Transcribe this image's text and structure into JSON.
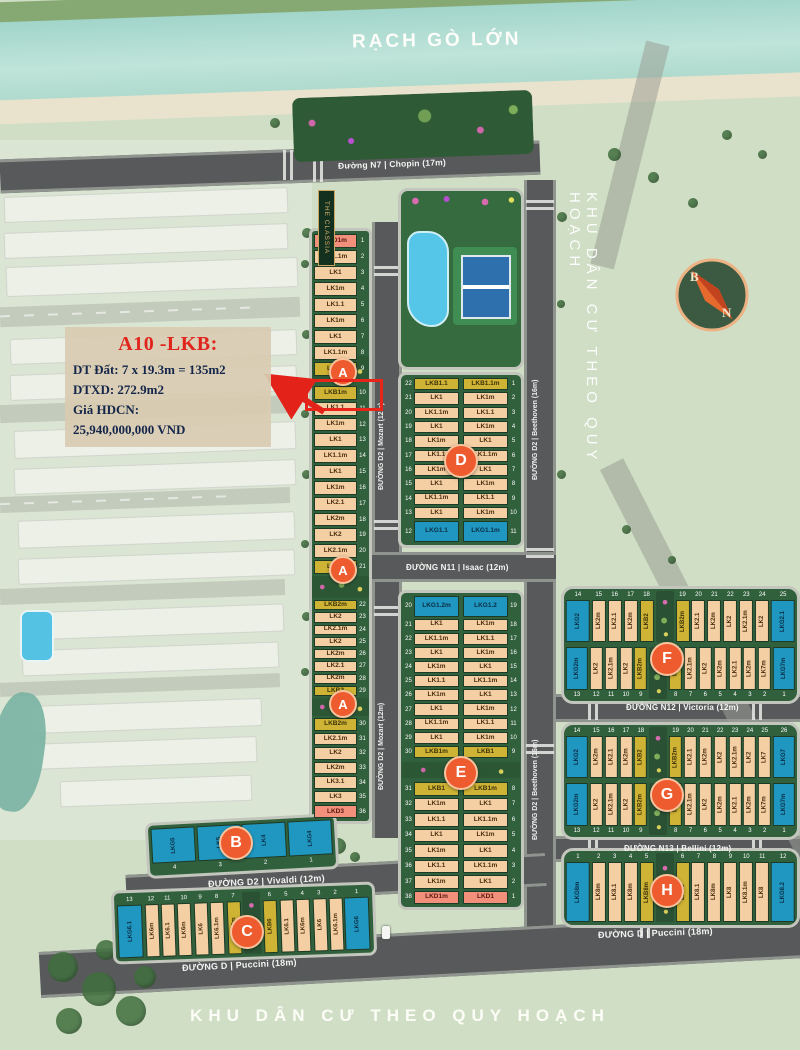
{
  "labels": {
    "river": "RẠCH GÒ LỚN",
    "zone_right": "KHU DÂN CƯ THEO QUY HOẠCH",
    "zone_bottom": "KHU DÂN CƯ THEO QUY HOẠCH",
    "project_sign": "THE CLASSIA"
  },
  "compass": {
    "north": "B",
    "south": "N"
  },
  "annotation": {
    "title": "A10 -LKB:",
    "line1": "DT Đất: 7 x 19.3m = 135m2",
    "line2": "DTXD: 272.9m2",
    "line3": "Giá HDCN:",
    "line4": "25,940,000,000 VND"
  },
  "roads": {
    "n7": "Đường N7 | Chopin (17m)",
    "mozart": "ĐƯỜNG D2 | Mozart (12m)",
    "beethoven": "ĐƯỜNG D2 | Beethoven (16m)",
    "isaac": "ĐƯỜNG N11 | Isaac (12m)",
    "victoria": "ĐƯỜNG N12 | Victoria (12m)",
    "bellini": "ĐƯỜNG N13 | Bellini (12m)",
    "vivaldi": "ĐƯỜNG D2 | Vivaldi (12m)",
    "puccini": "ĐƯỜNG D | Puccini (18m)"
  },
  "badges": {
    "a": "A",
    "b": "B",
    "c": "C",
    "d": "D",
    "e": "E",
    "f": "F",
    "g": "G",
    "h": "H"
  },
  "colors": {
    "lot_tan": "#f4cfa3",
    "lot_yellow": "#cfb335",
    "lot_salmon": "#f2907b",
    "lot_blue": "#2097c0",
    "block_green": "#31603c",
    "badge_orange": "#ed5b2f",
    "road_gray": "#57595b",
    "highlight_red": "#e8251a",
    "river_teal": "#a2d5ca"
  },
  "blocks": {
    "a1": [
      {
        "n": 1,
        "t": "LKD1m",
        "c": "s"
      },
      {
        "n": 2,
        "t": "LK1.1m",
        "c": "t"
      },
      {
        "n": 3,
        "t": "LK1",
        "c": "t"
      },
      {
        "n": 4,
        "t": "LK1m",
        "c": "t"
      },
      {
        "n": 5,
        "t": "LK1.1",
        "c": "t"
      },
      {
        "n": 6,
        "t": "LK1m",
        "c": "t"
      },
      {
        "n": 7,
        "t": "LK1",
        "c": "t"
      },
      {
        "n": 8,
        "t": "LK1.1m",
        "c": "t"
      },
      {
        "n": 9,
        "t": "LKB1",
        "c": "y"
      }
    ],
    "a2": [
      {
        "n": 10,
        "t": "LKB1m",
        "c": "y"
      },
      {
        "n": 11,
        "t": "LK1.1",
        "c": "t"
      },
      {
        "n": 12,
        "t": "LK1m",
        "c": "t"
      },
      {
        "n": 13,
        "t": "LK1",
        "c": "t"
      },
      {
        "n": 14,
        "t": "LK1.1m",
        "c": "t"
      },
      {
        "n": 15,
        "t": "LK1",
        "c": "t"
      },
      {
        "n": 16,
        "t": "LK1m",
        "c": "t"
      },
      {
        "n": 17,
        "t": "LK2.1",
        "c": "t"
      },
      {
        "n": 18,
        "t": "LK2m",
        "c": "t"
      },
      {
        "n": 19,
        "t": "LK2",
        "c": "t"
      },
      {
        "n": 20,
        "t": "LK2.1m",
        "c": "t"
      },
      {
        "n": 21,
        "t": "LKB2",
        "c": "y"
      }
    ],
    "a3": [
      {
        "n": 22,
        "t": "LKB2m",
        "c": "y"
      },
      {
        "n": 23,
        "t": "LK2",
        "c": "t"
      },
      {
        "n": 24,
        "t": "LK2.1m",
        "c": "t"
      },
      {
        "n": 25,
        "t": "LK2",
        "c": "t"
      },
      {
        "n": 26,
        "t": "LK2m",
        "c": "t"
      },
      {
        "n": 27,
        "t": "LK2.1",
        "c": "t"
      },
      {
        "n": 28,
        "t": "LK2m",
        "c": "t"
      },
      {
        "n": 29,
        "t": "LKB2",
        "c": "y"
      }
    ],
    "a4": [
      {
        "n": 30,
        "t": "LKB2m",
        "c": "y"
      },
      {
        "n": 31,
        "t": "LK2.1m",
        "c": "t"
      },
      {
        "n": 32,
        "t": "LK2",
        "c": "t"
      },
      {
        "n": 33,
        "t": "LK2m",
        "c": "t"
      },
      {
        "n": 34,
        "t": "LK3.1",
        "c": "t"
      },
      {
        "n": 35,
        "t": "LK3",
        "c": "t"
      },
      {
        "n": 36,
        "t": "LKD3",
        "c": "s"
      }
    ],
    "d_left": [
      {
        "n": 22,
        "t": "LKB1.1",
        "c": "y"
      },
      {
        "n": 21,
        "t": "LK1",
        "c": "t"
      },
      {
        "n": 20,
        "t": "LK1.1m",
        "c": "t"
      },
      {
        "n": 19,
        "t": "LK1",
        "c": "t"
      },
      {
        "n": 18,
        "t": "LK1m",
        "c": "t"
      },
      {
        "n": 17,
        "t": "LK1.1",
        "c": "t"
      },
      {
        "n": 16,
        "t": "LK1m",
        "c": "t"
      },
      {
        "n": 15,
        "t": "LK1",
        "c": "t"
      },
      {
        "n": 14,
        "t": "LK1.1m",
        "c": "t"
      },
      {
        "n": 13,
        "t": "LK1",
        "c": "t"
      },
      {
        "n": 12,
        "t": "LKG1.1",
        "c": "b"
      }
    ],
    "d_right": [
      {
        "n": 1,
        "t": "LKB1.1m",
        "c": "y"
      },
      {
        "n": 2,
        "t": "LK1m",
        "c": "t"
      },
      {
        "n": 3,
        "t": "LK1.1",
        "c": "t"
      },
      {
        "n": 4,
        "t": "LK1m",
        "c": "t"
      },
      {
        "n": 5,
        "t": "LK1",
        "c": "t"
      },
      {
        "n": 6,
        "t": "LK1.1m",
        "c": "t"
      },
      {
        "n": 7,
        "t": "LK1",
        "c": "t"
      },
      {
        "n": 8,
        "t": "LK1m",
        "c": "t"
      },
      {
        "n": 9,
        "t": "LK1.1",
        "c": "t"
      },
      {
        "n": 10,
        "t": "LK1m",
        "c": "t"
      },
      {
        "n": 11,
        "t": "LKG1.1m",
        "c": "b"
      }
    ],
    "e_top_left": [
      {
        "n": 20,
        "t": "LKG1.2m",
        "c": "b"
      },
      {
        "n": 21,
        "t": "LK1",
        "c": "t"
      },
      {
        "n": 22,
        "t": "LK1.1m",
        "c": "t"
      },
      {
        "n": 23,
        "t": "LK1",
        "c": "t"
      },
      {
        "n": 24,
        "t": "LK1m",
        "c": "t"
      },
      {
        "n": 25,
        "t": "LK1.1",
        "c": "t"
      },
      {
        "n": 26,
        "t": "LK1m",
        "c": "t"
      },
      {
        "n": 27,
        "t": "LK1",
        "c": "t"
      },
      {
        "n": 28,
        "t": "LK1.1m",
        "c": "t"
      },
      {
        "n": 29,
        "t": "LK1",
        "c": "t"
      },
      {
        "n": 30,
        "t": "LKB1m",
        "c": "y"
      }
    ],
    "e_top_right": [
      {
        "n": 19,
        "t": "LKG1.2",
        "c": "b"
      },
      {
        "n": 18,
        "t": "LK1m",
        "c": "t"
      },
      {
        "n": 17,
        "t": "LK1.1",
        "c": "t"
      },
      {
        "n": 16,
        "t": "LK1m",
        "c": "t"
      },
      {
        "n": 15,
        "t": "LK1",
        "c": "t"
      },
      {
        "n": 14,
        "t": "LK1.1m",
        "c": "t"
      },
      {
        "n": 13,
        "t": "LK1",
        "c": "t"
      },
      {
        "n": 12,
        "t": "LK1m",
        "c": "t"
      },
      {
        "n": 11,
        "t": "LK1.1",
        "c": "t"
      },
      {
        "n": 10,
        "t": "LK1m",
        "c": "t"
      },
      {
        "n": 9,
        "t": "LKB1",
        "c": "y"
      }
    ],
    "e_bot_left": [
      {
        "n": 31,
        "t": "LKB1",
        "c": "y"
      },
      {
        "n": 32,
        "t": "LK1m",
        "c": "t"
      },
      {
        "n": 33,
        "t": "LK1.1",
        "c": "t"
      },
      {
        "n": 34,
        "t": "LK1",
        "c": "t"
      },
      {
        "n": 35,
        "t": "LK1m",
        "c": "t"
      },
      {
        "n": 36,
        "t": "LK1.1",
        "c": "t"
      },
      {
        "n": 37,
        "t": "LK1m",
        "c": "t"
      },
      {
        "n": 38,
        "t": "LKD1m",
        "c": "s"
      }
    ],
    "e_bot_right": [
      {
        "n": 8,
        "t": "LKB1m",
        "c": "y"
      },
      {
        "n": 7,
        "t": "LK1",
        "c": "t"
      },
      {
        "n": 6,
        "t": "LK1.1m",
        "c": "t"
      },
      {
        "n": 5,
        "t": "LK1m",
        "c": "t"
      },
      {
        "n": 4,
        "t": "LK1",
        "c": "t"
      },
      {
        "n": 3,
        "t": "LK1.1m",
        "c": "t"
      },
      {
        "n": 2,
        "t": "LK1",
        "c": "t"
      },
      {
        "n": 1,
        "t": "LKD1",
        "c": "s"
      }
    ],
    "f_top": [
      {
        "n": 14,
        "t": "LKG2",
        "c": "b"
      },
      {
        "n": 15,
        "t": "LK2m",
        "c": "t"
      },
      {
        "n": 16,
        "t": "LK2.1",
        "c": "t"
      },
      {
        "n": 17,
        "t": "LK2m",
        "c": "t"
      },
      {
        "n": 18,
        "t": "LKB2",
        "c": "y"
      },
      {
        "gap": true
      },
      {
        "n": 19,
        "t": "LKB2m",
        "c": "y"
      },
      {
        "n": 20,
        "t": "LK2.1",
        "c": "t"
      },
      {
        "n": 21,
        "t": "LK2m",
        "c": "t"
      },
      {
        "n": 22,
        "t": "LK2",
        "c": "t"
      },
      {
        "n": 23,
        "t": "LK2.1m",
        "c": "t"
      },
      {
        "n": 24,
        "t": "LK2",
        "c": "t"
      },
      {
        "n": 25,
        "t": "LKG2.1",
        "c": "b"
      }
    ],
    "f_bot": [
      {
        "n": 13,
        "t": "LKG2m",
        "c": "b"
      },
      {
        "n": 12,
        "t": "LK2",
        "c": "t"
      },
      {
        "n": 11,
        "t": "LK2.1m",
        "c": "t"
      },
      {
        "n": 10,
        "t": "LK2",
        "c": "t"
      },
      {
        "n": 9,
        "t": "LKB2m",
        "c": "y"
      },
      {
        "gap": true
      },
      {
        "n": 8,
        "t": "LKB2",
        "c": "y"
      },
      {
        "n": 7,
        "t": "LK2.1m",
        "c": "t"
      },
      {
        "n": 6,
        "t": "LK2",
        "c": "t"
      },
      {
        "n": 5,
        "t": "LK2m",
        "c": "t"
      },
      {
        "n": 4,
        "t": "LK2.1",
        "c": "t"
      },
      {
        "n": 3,
        "t": "LK2m",
        "c": "t"
      },
      {
        "n": 2,
        "t": "LK7m",
        "c": "t"
      },
      {
        "n": 1,
        "t": "LKG7m",
        "c": "b"
      }
    ],
    "g_top": [
      {
        "n": 14,
        "t": "LKG2",
        "c": "b"
      },
      {
        "n": 15,
        "t": "LK2m",
        "c": "t"
      },
      {
        "n": 16,
        "t": "LK2.1",
        "c": "t"
      },
      {
        "n": 17,
        "t": "LK2m",
        "c": "t"
      },
      {
        "n": 18,
        "t": "LKB2",
        "c": "y"
      },
      {
        "gap": true
      },
      {
        "n": 19,
        "t": "LKB2m",
        "c": "y"
      },
      {
        "n": 20,
        "t": "LK2.1",
        "c": "t"
      },
      {
        "n": 21,
        "t": "LK2m",
        "c": "t"
      },
      {
        "n": 22,
        "t": "LK2",
        "c": "t"
      },
      {
        "n": 23,
        "t": "LK2.1m",
        "c": "t"
      },
      {
        "n": 24,
        "t": "LK2",
        "c": "t"
      },
      {
        "n": 25,
        "t": "LK7",
        "c": "t"
      },
      {
        "n": 26,
        "t": "LKG7",
        "c": "b"
      }
    ],
    "g_bot": [
      {
        "n": 13,
        "t": "LKG2m",
        "c": "b"
      },
      {
        "n": 12,
        "t": "LK2",
        "c": "t"
      },
      {
        "n": 11,
        "t": "LK2.1m",
        "c": "t"
      },
      {
        "n": 10,
        "t": "LK2",
        "c": "t"
      },
      {
        "n": 9,
        "t": "LKB2m",
        "c": "y"
      },
      {
        "gap": true
      },
      {
        "n": 8,
        "t": "LKB2",
        "c": "y"
      },
      {
        "n": 7,
        "t": "LK2.1m",
        "c": "t"
      },
      {
        "n": 6,
        "t": "LK2",
        "c": "t"
      },
      {
        "n": 5,
        "t": "LK2m",
        "c": "t"
      },
      {
        "n": 4,
        "t": "LK2.1",
        "c": "t"
      },
      {
        "n": 3,
        "t": "LK2m",
        "c": "t"
      },
      {
        "n": 2,
        "t": "LK7m",
        "c": "t"
      },
      {
        "n": 1,
        "t": "LKG7m",
        "c": "b"
      }
    ],
    "h": [
      {
        "n": 1,
        "t": "LKG8m",
        "c": "b"
      },
      {
        "n": 2,
        "t": "LK8m",
        "c": "t"
      },
      {
        "n": 3,
        "t": "LK8.1",
        "c": "t"
      },
      {
        "n": 4,
        "t": "LK8m",
        "c": "t"
      },
      {
        "n": 5,
        "t": "LKB8m",
        "c": "y"
      },
      {
        "gap": true
      },
      {
        "n": 6,
        "t": "LKB8",
        "c": "y"
      },
      {
        "n": 7,
        "t": "LK8.1",
        "c": "t"
      },
      {
        "n": 8,
        "t": "LK8m",
        "c": "t"
      },
      {
        "n": 9,
        "t": "LK8",
        "c": "t"
      },
      {
        "n": 10,
        "t": "LK8.1m",
        "c": "t"
      },
      {
        "n": 11,
        "t": "LK8",
        "c": "t"
      },
      {
        "n": 12,
        "t": "LKG8.2",
        "c": "b"
      }
    ],
    "b": [
      {
        "n": 4,
        "t": "LKG5",
        "c": "b"
      },
      {
        "n": 3,
        "t": "LK5",
        "c": "b"
      },
      {
        "n": 2,
        "t": "LK4",
        "c": "b"
      },
      {
        "n": 1,
        "t": "LKG4",
        "c": "b"
      }
    ],
    "c": [
      {
        "n": 13,
        "t": "LKG6.1",
        "c": "b"
      },
      {
        "n": 12,
        "t": "LK6m",
        "c": "t"
      },
      {
        "n": 11,
        "t": "LK6.1",
        "c": "t"
      },
      {
        "n": 10,
        "t": "LK6m",
        "c": "t"
      },
      {
        "n": 9,
        "t": "LK6",
        "c": "t"
      },
      {
        "n": 8,
        "t": "LK6.1m",
        "c": "t"
      },
      {
        "n": 7,
        "t": "LKB6m",
        "c": "y"
      },
      {
        "gap": true
      },
      {
        "n": 6,
        "t": "LKB6",
        "c": "y"
      },
      {
        "n": 5,
        "t": "LK6.1",
        "c": "t"
      },
      {
        "n": 4,
        "t": "LK6m",
        "c": "t"
      },
      {
        "n": 3,
        "t": "LK6",
        "c": "t"
      },
      {
        "n": 2,
        "t": "LK6.1m",
        "c": "t"
      },
      {
        "n": 1,
        "t": "LKG6",
        "c": "b"
      }
    ]
  }
}
